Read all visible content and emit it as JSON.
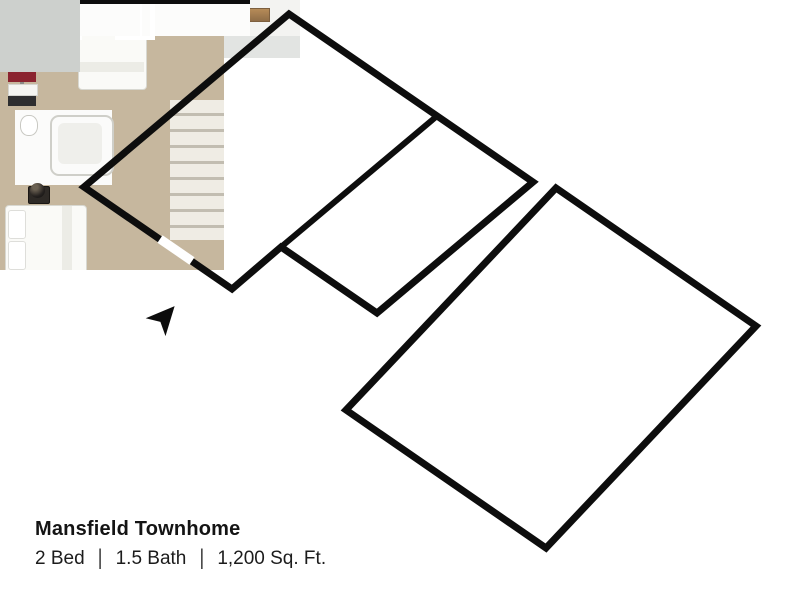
{
  "plan": {
    "title": "Mansfield Townhome",
    "specs": {
      "beds": "2 Bed",
      "baths": "1.5 Bath",
      "area": "1,200 Sq. Ft.",
      "separator": "|"
    }
  },
  "icons": {
    "entry_arrow": "➤"
  },
  "colors": {
    "outline": "#0d0d0d",
    "first_floor": "#cbbfae",
    "rug": "#e8e1d3",
    "carpet": "#c6b79e",
    "concrete_room": "#b9bdbd",
    "cabinet_wood": "#c89a6d",
    "wall_white": "#f6f6f4",
    "exterior_shade": "#e2e4e2",
    "sofa": "#3a393e",
    "lamp_accent": "#d4b03a"
  }
}
